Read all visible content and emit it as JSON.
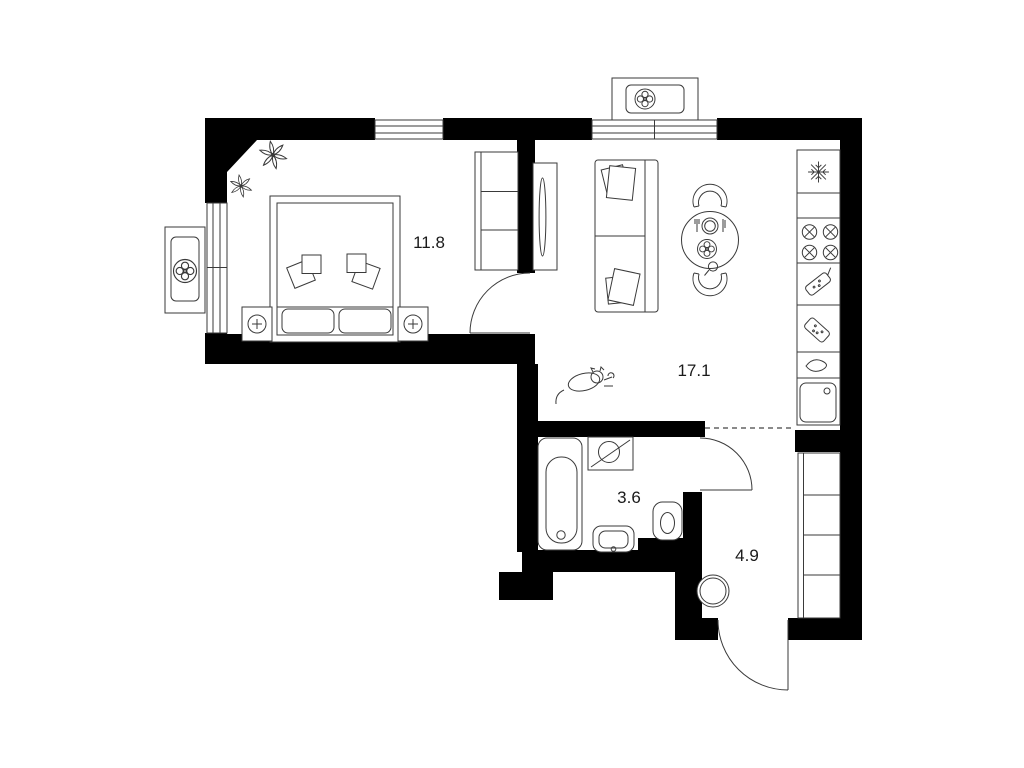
{
  "plan": {
    "title": "apartment-floor-plan",
    "rooms": [
      {
        "name": "bedroom",
        "area": "11.8"
      },
      {
        "name": "living-kitchen",
        "area": "17.1"
      },
      {
        "name": "bathroom",
        "area": "3.6"
      },
      {
        "name": "hallway",
        "area": "4.9"
      }
    ]
  },
  "colors": {
    "wall": "#000000",
    "furniture_line": "#3a3a3a",
    "label_text": "#1a1a1a",
    "background": "#ffffff"
  },
  "icons": {
    "air_conditioner": "fan-pinwheel-icon",
    "fridge": "snowflake-icon",
    "stove": "burner-cross-circles-icon",
    "washing_machine": "drum-circle-diagonal-icon",
    "nightstand_lamp": "circle-cross-icon",
    "table_setting": "plate-fork-knife-icon",
    "sink_tap": "drop-icon"
  }
}
